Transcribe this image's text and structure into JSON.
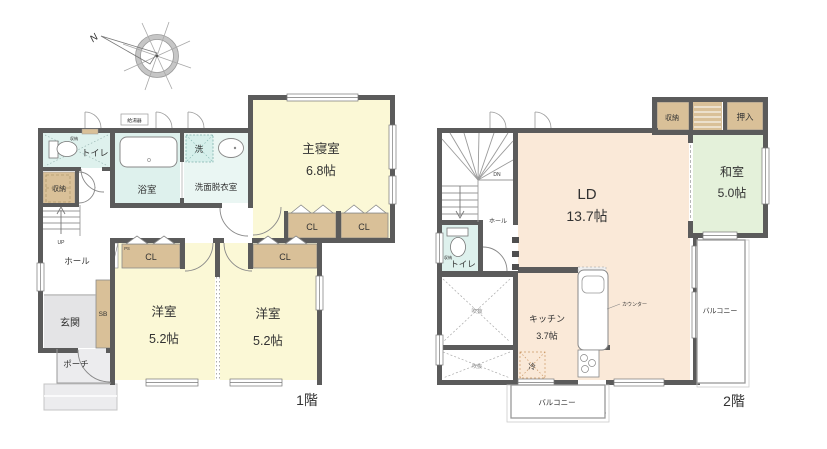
{
  "palette": {
    "wall": "#5b5b5b",
    "room_yellow": "#fbf8d6",
    "room_cyan": "#def1ed",
    "room_cyan_light": "#eaf6f3",
    "room_peach": "#fae9d8",
    "room_green": "#e4f1da",
    "closet_tan": "#d9c098",
    "entry_gray": "#e4e4e6",
    "porch_gray": "#ececee"
  },
  "compass": {
    "north": "N"
  },
  "floor1": {
    "floor_label": "1階",
    "master_bedroom": {
      "name": "主寝室",
      "size": "6.8帖"
    },
    "western_room_1": {
      "name": "洋室",
      "size": "5.2帖"
    },
    "western_room_2": {
      "name": "洋室",
      "size": "5.2帖"
    },
    "bathroom": "浴室",
    "laundry_room": "洗面脱衣室",
    "washer": "洗",
    "water_heater": "給湯器",
    "toilet": "トイレ",
    "toilet_shelf": "収納",
    "storage": "収納",
    "hall": "ホール",
    "entrance": "玄関",
    "shoe_box": "SB",
    "porch": "ポーチ",
    "closet": "CL",
    "pipe_space": "PS",
    "stairs_up": "UP"
  },
  "floor2": {
    "floor_label": "2階",
    "living_dining": {
      "name": "LD",
      "size": "13.7帖"
    },
    "kitchen": {
      "name": "キッチン",
      "size": "3.7帖"
    },
    "japanese_room": {
      "name": "和室",
      "size": "5.0帖"
    },
    "oshiire": "押入",
    "storage": "収納",
    "toilet": "トイレ",
    "toilet_shelf": "収納",
    "hall": "ホール",
    "stairs_down": "DN",
    "void": "吹抜",
    "refrigerator": "冷",
    "counter": "カウンター",
    "balcony": "バルコニー"
  }
}
